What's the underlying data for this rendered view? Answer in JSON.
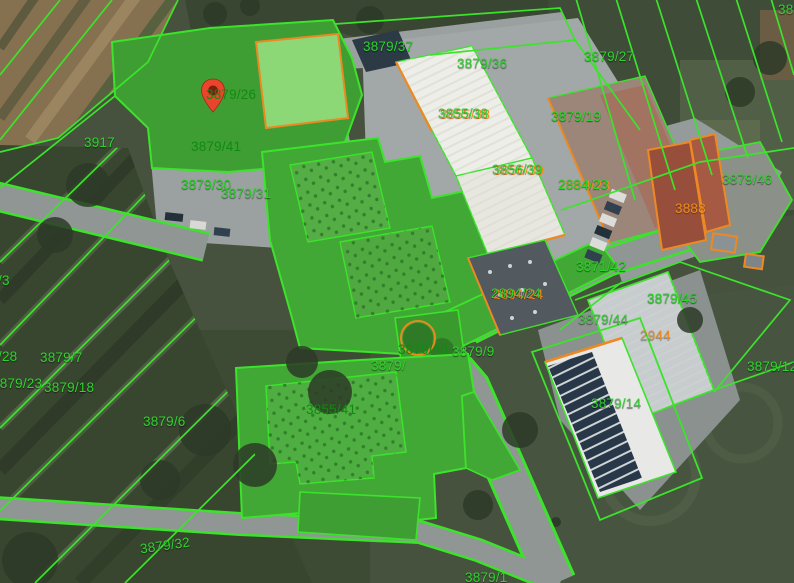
{
  "map": {
    "type": "cadastral-parcel-overlay-on-aerial",
    "marker": {
      "x": 200,
      "y": 78,
      "color": "#e8452c",
      "inner_color": "#7e1d10"
    },
    "colors": {
      "parcel_line_green": "#3ce32b",
      "building_line_orange": "#ee8822",
      "label_green": "#2fd32f",
      "label_dark_green": "#108a10",
      "label_orange": "#ef8c1e",
      "highlight_fill_green": "#41a835",
      "pavement_grey": "#9aa09f"
    },
    "labels": [
      {
        "text": "3879/37",
        "x": 363,
        "y": 40,
        "color": "green"
      },
      {
        "text": "3879/36",
        "x": 457,
        "y": 57,
        "color": "green"
      },
      {
        "text": "3855/38",
        "x": 438,
        "y": 107,
        "color": "dual"
      },
      {
        "text": "3879/19",
        "x": 551,
        "y": 110,
        "color": "green"
      },
      {
        "text": "3879/27",
        "x": 584,
        "y": 50,
        "color": "green"
      },
      {
        "text": "3917",
        "x": 84,
        "y": 136,
        "color": "green"
      },
      {
        "text": "3879/26",
        "x": 206,
        "y": 88,
        "color": "dark"
      },
      {
        "text": "3879/41",
        "x": 191,
        "y": 140,
        "color": "dark"
      },
      {
        "text": "3879/30",
        "x": 181,
        "y": 178,
        "color": "green"
      },
      {
        "text": "3879/31",
        "x": 221,
        "y": 187,
        "color": "green"
      },
      {
        "text": "3856/39",
        "x": 492,
        "y": 163,
        "color": "dual"
      },
      {
        "text": "2884/23",
        "x": 558,
        "y": 178,
        "color": "dual"
      },
      {
        "text": "3879/46",
        "x": 722,
        "y": 173,
        "color": "green"
      },
      {
        "text": "3888",
        "x": 675,
        "y": 202,
        "color": "orange"
      },
      {
        "text": "3871/42",
        "x": 576,
        "y": 260,
        "color": "green"
      },
      {
        "text": "2894/24",
        "x": 491,
        "y": 287,
        "color": "dual"
      },
      {
        "text": "3879/45",
        "x": 647,
        "y": 292,
        "color": "green"
      },
      {
        "text": "3879/44",
        "x": 578,
        "y": 313,
        "color": "green"
      },
      {
        "text": "2944",
        "x": 640,
        "y": 329,
        "color": "orange"
      },
      {
        "text": "3879/12",
        "x": 747,
        "y": 360,
        "color": "green"
      },
      {
        "text": "3879/14",
        "x": 591,
        "y": 397,
        "color": "green"
      },
      {
        "text": "3879/40",
        "x": 398,
        "y": 343,
        "color": "dark"
      },
      {
        "text": "3879/9",
        "x": 452,
        "y": 345,
        "color": "green"
      },
      {
        "text": "3879/",
        "x": 371,
        "y": 359,
        "color": "green"
      },
      {
        "text": "3855/41",
        "x": 306,
        "y": 403,
        "color": "dark"
      },
      {
        "text": "3879/6",
        "x": 143,
        "y": 415,
        "color": "green"
      },
      {
        "text": "3879/7",
        "x": 40,
        "y": 351,
        "color": "green"
      },
      {
        "text": "/28",
        "x": -2,
        "y": 350,
        "color": "green"
      },
      {
        "text": "3879/23",
        "x": -8,
        "y": 377,
        "color": "green"
      },
      {
        "text": "3879/18",
        "x": 44,
        "y": 381,
        "color": "green"
      },
      {
        "text": "/3",
        "x": -2,
        "y": 274,
        "color": "green"
      },
      {
        "text": "3879/32",
        "x": 140,
        "y": 539,
        "color": "green",
        "rot": -8
      },
      {
        "text": "3879/1",
        "x": 465,
        "y": 571,
        "color": "green"
      },
      {
        "text": "389",
        "x": 778,
        "y": 3,
        "color": "green"
      }
    ]
  }
}
